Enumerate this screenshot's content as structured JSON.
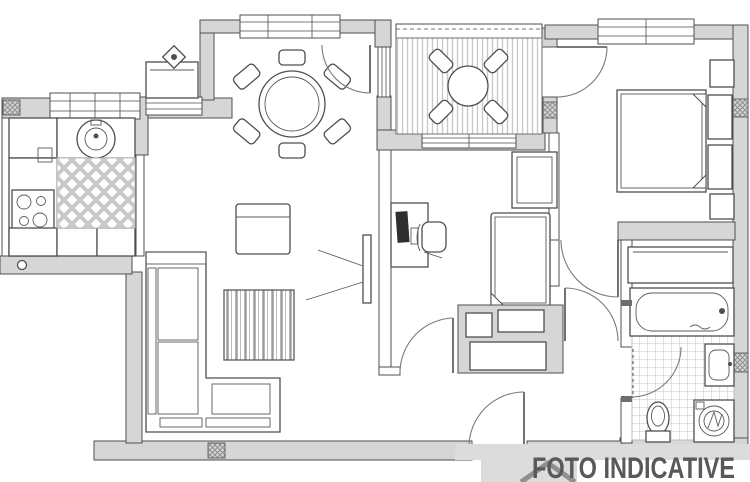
{
  "watermark": {
    "text": "FOTO INDICATIVE",
    "text_color": "#58595b",
    "banner_color": "#dcdcdc",
    "roof_color": "#8f8f8f"
  },
  "colors": {
    "background": "#ffffff",
    "wall_fill": "#d6d6d6",
    "line": "#4f4f4f",
    "pattern_light": "#c9c9c9",
    "hatch": "#8f8f8f"
  },
  "plan": {
    "type": "apartment-floor-plan",
    "rooms": [
      {
        "name": "kitchen",
        "symbols": [
          "round-sink",
          "four-burner-stove",
          "counters",
          "diamond-tile-floor"
        ]
      },
      {
        "name": "dining-area",
        "symbols": [
          "round-table",
          "six-chairs",
          "sideboard-with-decor",
          "window"
        ]
      },
      {
        "name": "living-area",
        "symbols": [
          "corner-sofa",
          "coffee-cabinet",
          "striped-rug",
          "tv-with-view-lines"
        ]
      },
      {
        "name": "balcony",
        "symbols": [
          "striped-floor",
          "round-table",
          "four-chairs",
          "railing"
        ]
      },
      {
        "name": "master-bedroom",
        "symbols": [
          "double-bed",
          "headboard",
          "two-nightstands",
          "window"
        ]
      },
      {
        "name": "study-bedroom",
        "symbols": [
          "desk",
          "monitor",
          "office-chair",
          "single-bed",
          "wardrobe"
        ]
      },
      {
        "name": "bathroom",
        "symbols": [
          "bathtub",
          "washbasin",
          "toilet",
          "washing-machine",
          "grid-tile-floor"
        ]
      },
      {
        "name": "hallway",
        "symbols": [
          "entry-door",
          "closet",
          "door-arcs"
        ]
      }
    ]
  }
}
